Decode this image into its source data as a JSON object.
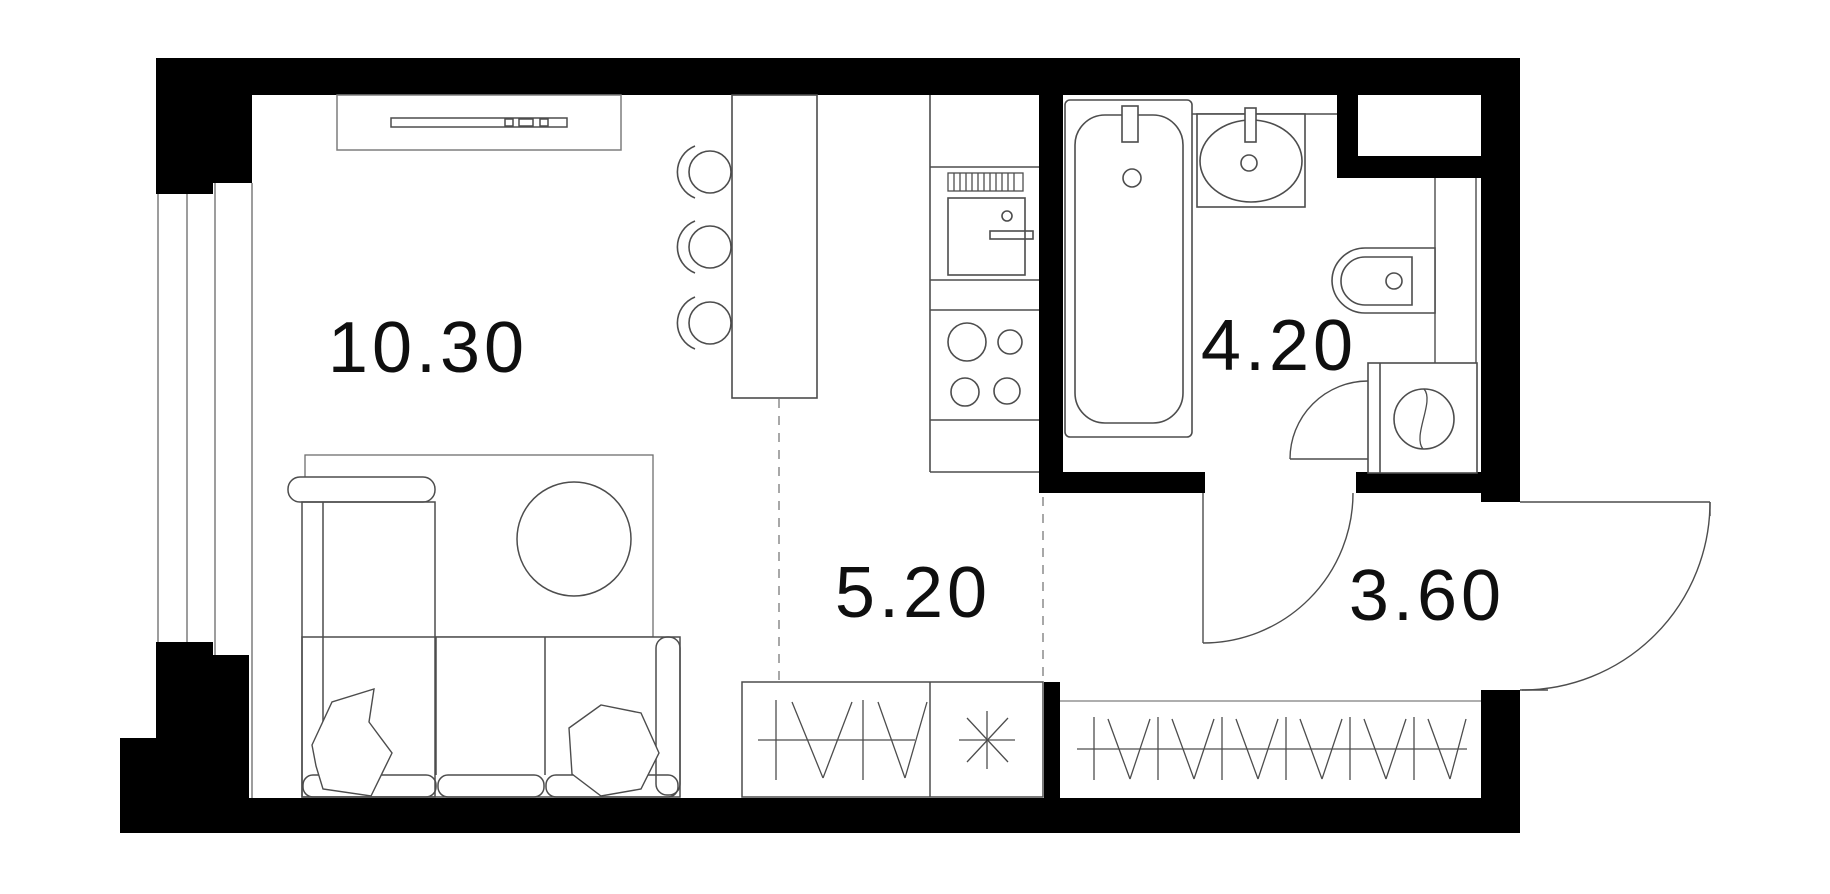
{
  "plan": {
    "type": "apartment-floor-plan",
    "rooms": {
      "living": {
        "label": "10.30"
      },
      "kitchen": {
        "label": "5.20"
      },
      "bathroom": {
        "label": "4.20"
      },
      "hallway": {
        "label": "3.60"
      }
    },
    "fixtures": [
      "window",
      "tv-console",
      "bar-counter",
      "bar-stools",
      "kitchen-counter",
      "vent-grill",
      "oven",
      "cooktop",
      "rug",
      "dining-table",
      "corner-sofa",
      "pillows",
      "bathtub",
      "wash-basin",
      "toilet",
      "washing-machine",
      "bathroom-door",
      "interior-door",
      "entrance-door",
      "wardrobe-kitchen",
      "wardrobe-hallway",
      "zone-divider-dashes"
    ],
    "colors": {
      "wall": "#000000",
      "fixture_line": "#4d4d4d",
      "light_line": "#7d7d7d",
      "dash_line": "#8c8c8c",
      "label_text": "#0f0f0f",
      "background": "#ffffff"
    }
  }
}
